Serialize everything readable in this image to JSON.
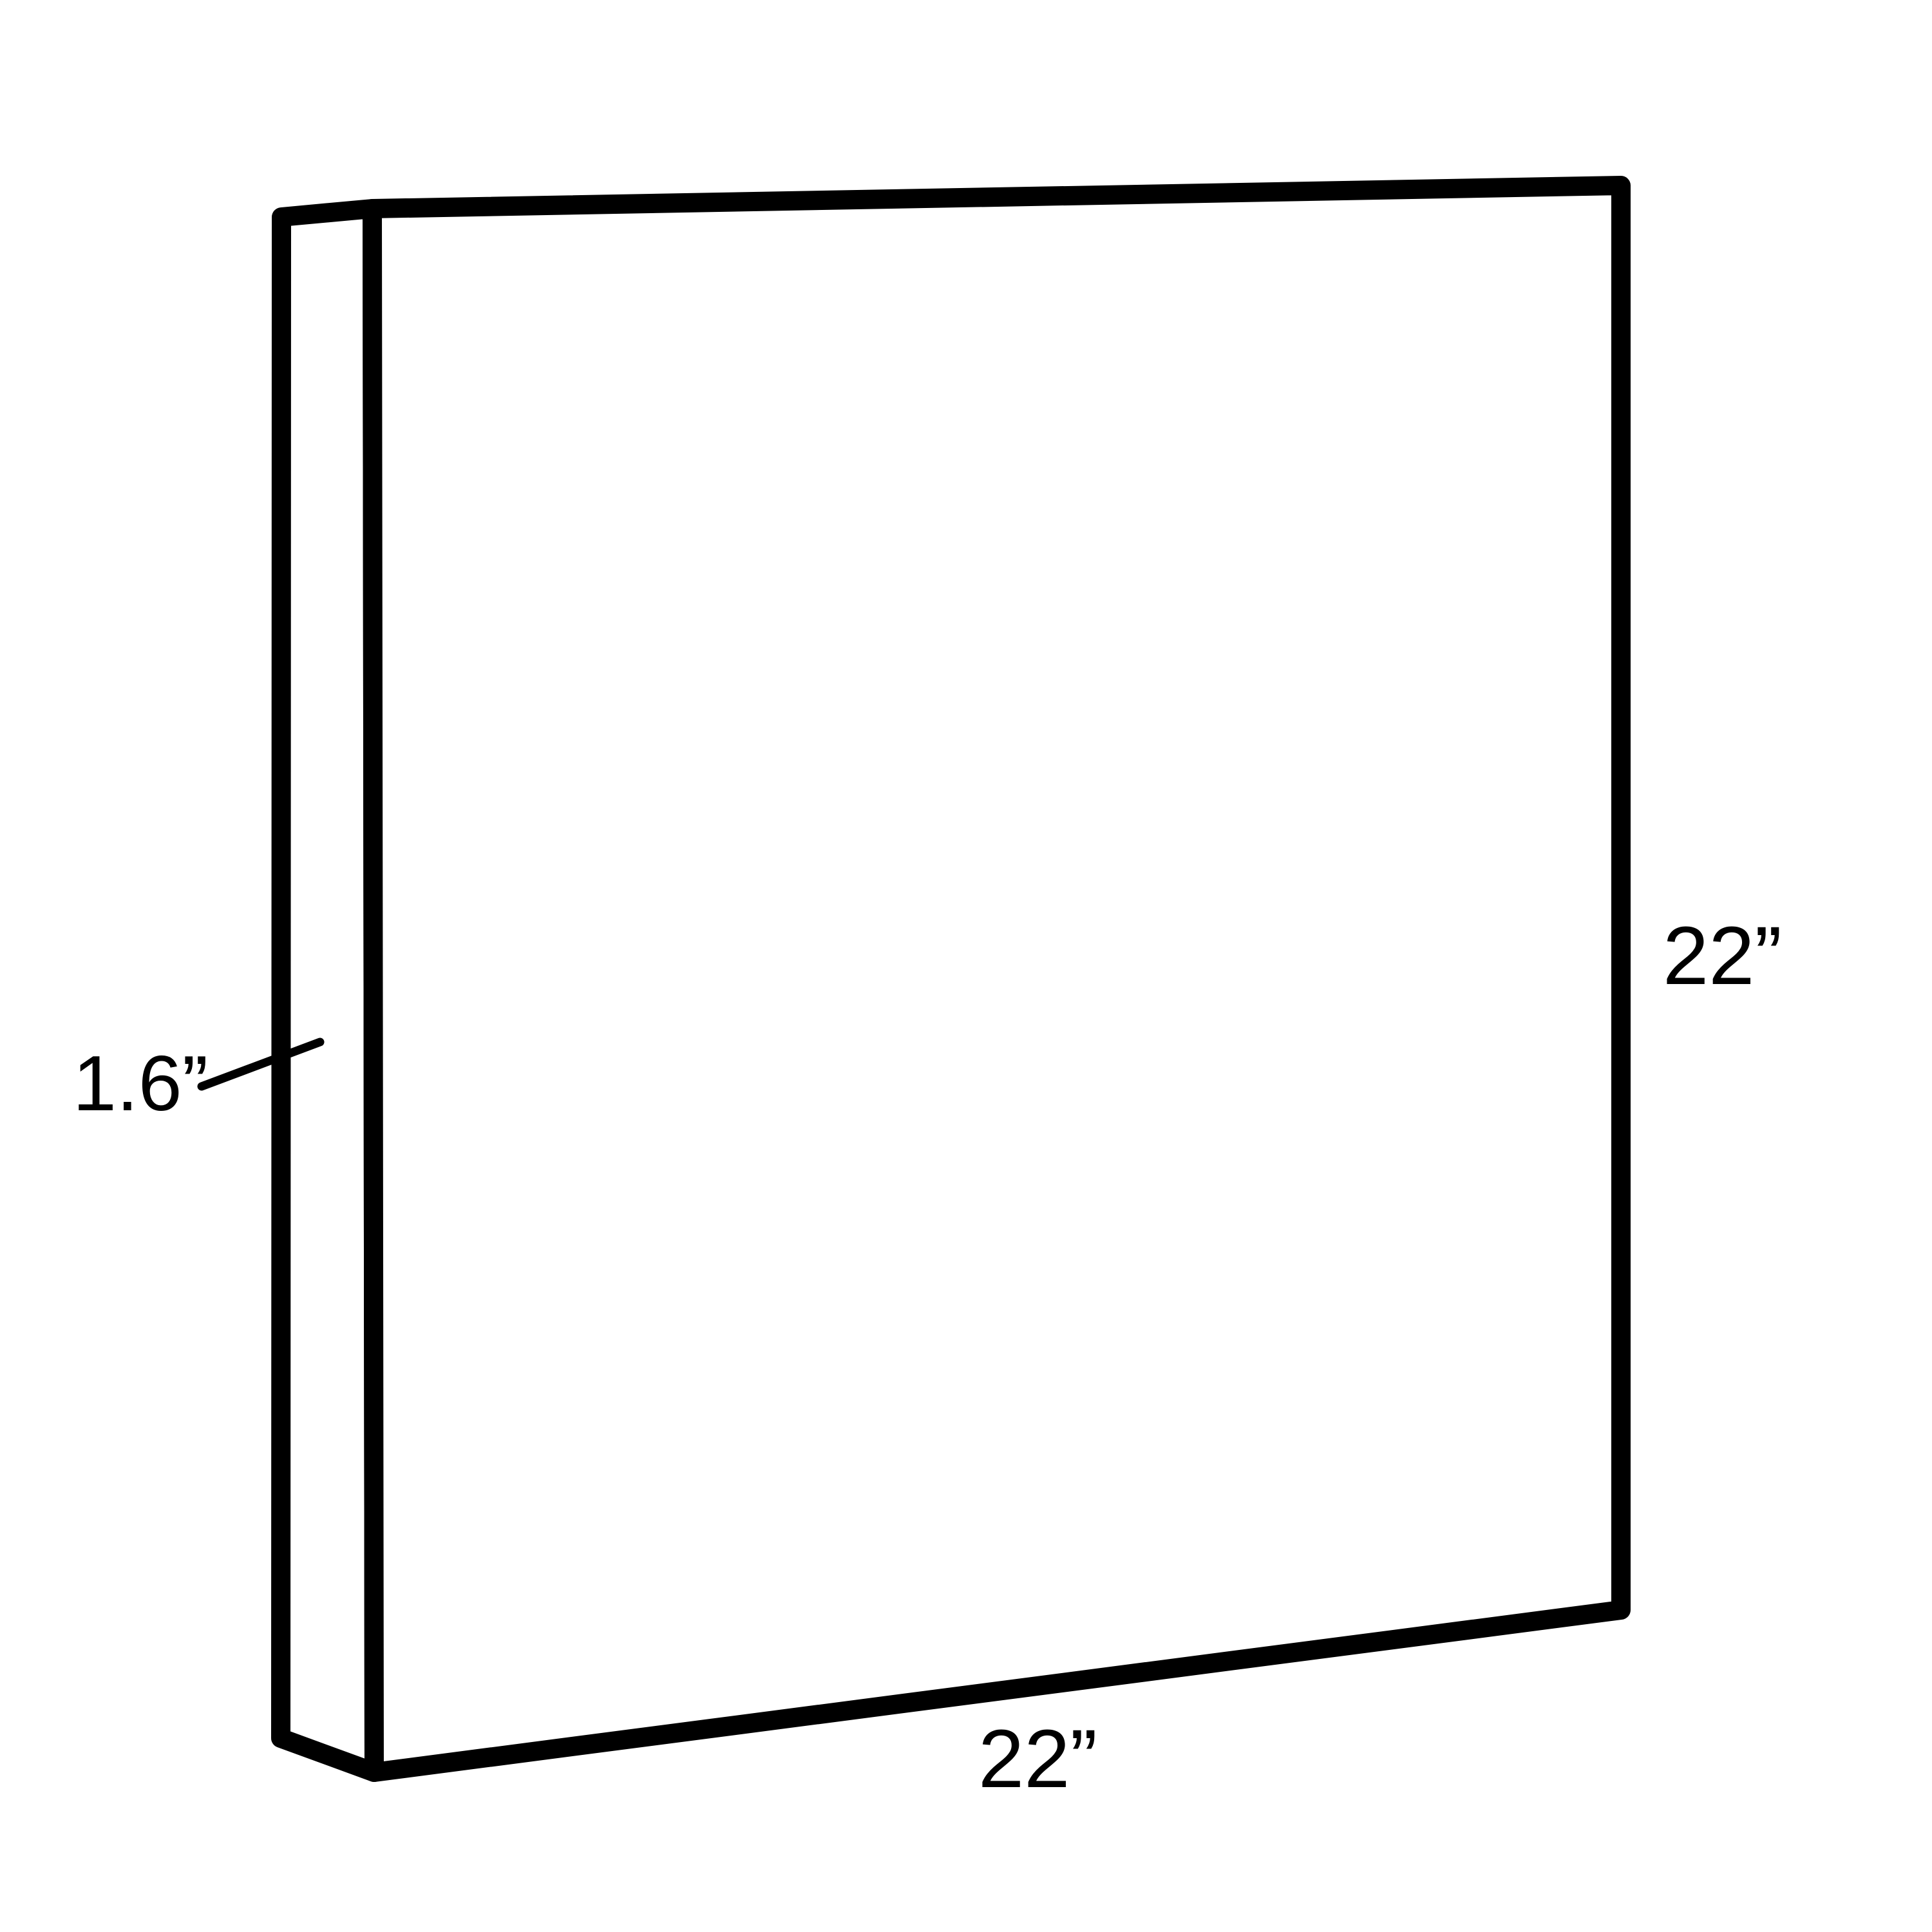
{
  "diagram": {
    "type": "3d-dimension-diagram",
    "subject": "thin rectangular panel drawn in perspective with dimension callouts",
    "background_color": "#ffffff",
    "line_color": "#000000",
    "labels": {
      "depth": "1.6”",
      "height": "22”",
      "width": "22”"
    },
    "dimensions_inches": {
      "width": 22,
      "height": 22,
      "depth": 1.6
    }
  }
}
